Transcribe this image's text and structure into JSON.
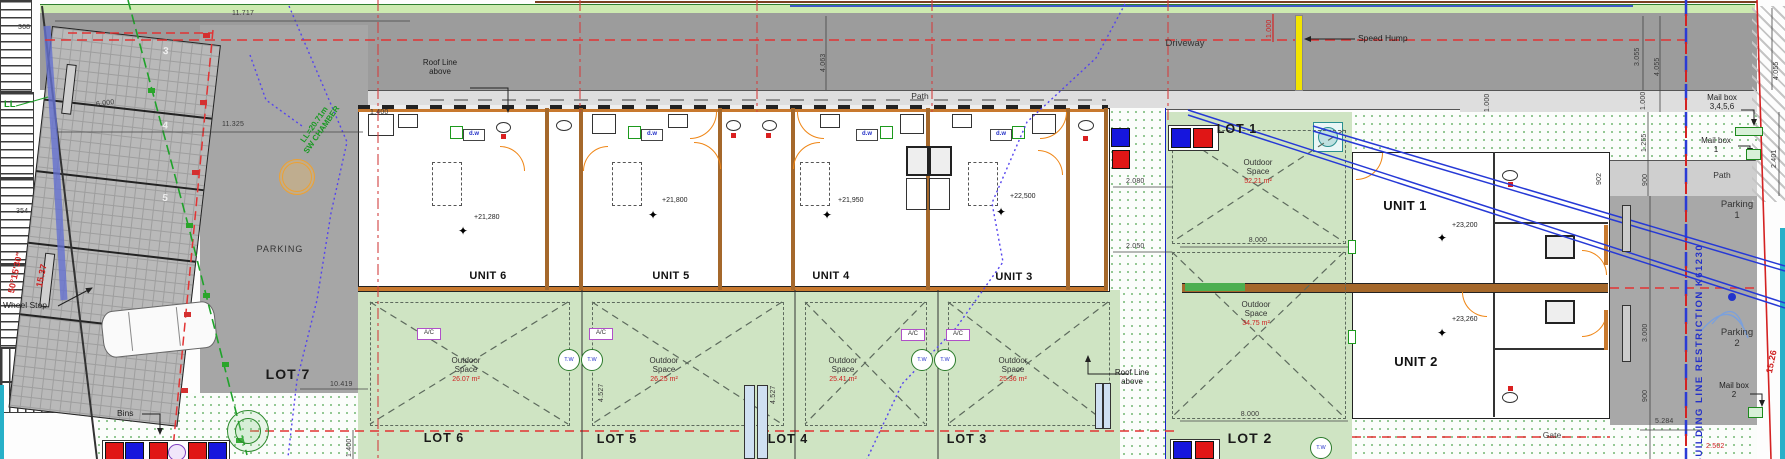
{
  "labels": {
    "driveway": "Driveway",
    "speed_hump": "Speed Hump",
    "path_top": "Path",
    "path_right": "Path",
    "parking_area": "PARKING",
    "lot7": "LOT 7",
    "wheel_stop": "Wheel Stop",
    "bins": "Bins",
    "ll": "LL",
    "sw_chamber_l1": "LL=20.71m",
    "sw_chamber_l2": "SW CHAMBER",
    "roof_line_l1": "Roof Line",
    "roof_line_l2": "above",
    "gate": "Gate",
    "building_line_restriction": "BUILDING LINE RESTRICTION K61230",
    "parking1_word": "Parking",
    "parking1_num": "1",
    "parking2_word": "Parking",
    "parking2_num": "2",
    "mailbox_word": "Mail box",
    "mailbox_a_nums": "3,4,5,6",
    "mailbox_b_num": "1",
    "mailbox_c_num": "2",
    "outdoor_space": "Outdoor Space"
  },
  "units": [
    {
      "name": "UNIT 6",
      "level": "+21,280"
    },
    {
      "name": "UNIT 5",
      "level": "+21,800"
    },
    {
      "name": "UNIT 4",
      "level": "+21,950"
    },
    {
      "name": "UNIT 3",
      "level": "+22,500"
    },
    {
      "name": "UNIT 1",
      "level": "+23,200"
    },
    {
      "name": "UNIT 2",
      "level": "+23,260"
    }
  ],
  "lots": [
    {
      "name": "LOT 6",
      "area": "26.07 m²"
    },
    {
      "name": "LOT 5",
      "area": "26.25 m²"
    },
    {
      "name": "LOT 4",
      "area": "25.41 m²"
    },
    {
      "name": "LOT 3",
      "area": "25.36 m²"
    },
    {
      "name": "LOT 1",
      "area": "52.21 m²"
    },
    {
      "name": "LOT 2",
      "area": "34.75 m²"
    }
  ],
  "stalls": [
    "3",
    "4",
    "5"
  ],
  "fixtures": {
    "dishwasher": "d.w",
    "air_con": "A/C",
    "tank_water": "T.W"
  },
  "survey": {
    "bearing": "50°15'30\"",
    "boundary_left": "15.37",
    "boundary_right": "15.26"
  },
  "symbols": {
    "level_star": "✦"
  },
  "dims": {
    "w11717": "11.717",
    "w11325": "11.325",
    "n368": "368",
    "n354": "354",
    "w6000": "6.000",
    "w10419": "10.419",
    "w1400a": "1.400",
    "w1400b": "1.400",
    "h4063": "4.063",
    "h3055": "3.055",
    "h4055a": "4.055",
    "h1000a": "1.000",
    "h4055b": "4.055",
    "h2401": "2.401",
    "h1255": "1.255",
    "h900a": "900",
    "h3000": "3.000",
    "h900b": "900",
    "w5284": "5.284",
    "w2080": "2.080",
    "w2050": "2.050",
    "w8000a": "8.000",
    "w8000b": "8.000",
    "h1000b": "1.000",
    "h902": "902",
    "h4527a": "4.527",
    "h4527b": "4.527",
    "h1000r": "1.000",
    "w2502": "2.502"
  }
}
